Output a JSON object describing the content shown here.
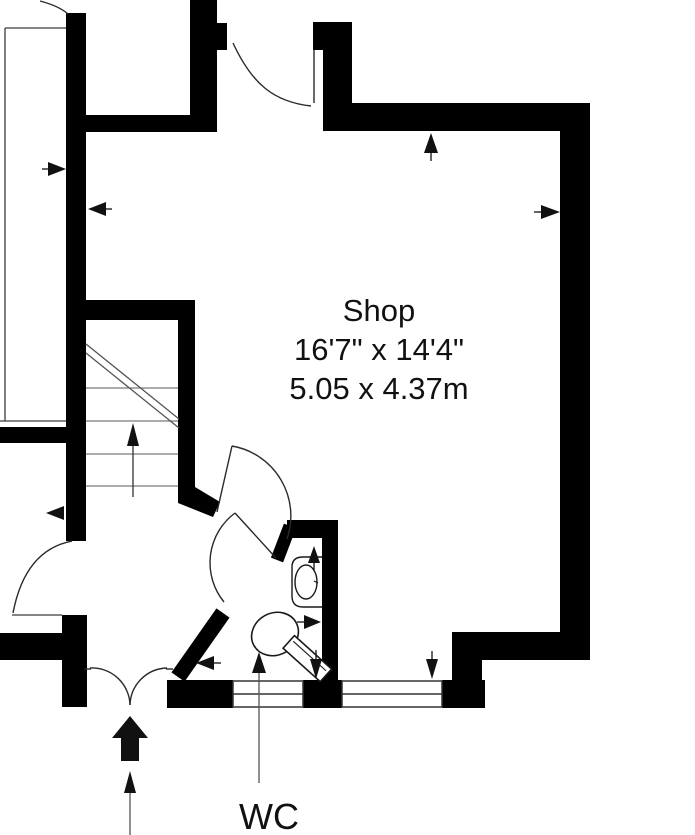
{
  "plan": {
    "room": {
      "name": "Shop",
      "size_imperial": "16'7\" x 14'4\"",
      "size_metric": "5.05 x 4.37m"
    },
    "wc": {
      "label": "WC"
    },
    "colors": {
      "wall": "#000000",
      "background": "#ffffff",
      "thin_line": "#3a3a3a",
      "tread_line": "#7a7a7a",
      "text": "#111111"
    },
    "symbols": [
      "entrance-arrow-icon",
      "stair-direction-arrow-icon",
      "measurement-arrow-icons",
      "door-swing-arcs",
      "window-symbols",
      "toilet-symbol",
      "sink-symbol"
    ]
  }
}
